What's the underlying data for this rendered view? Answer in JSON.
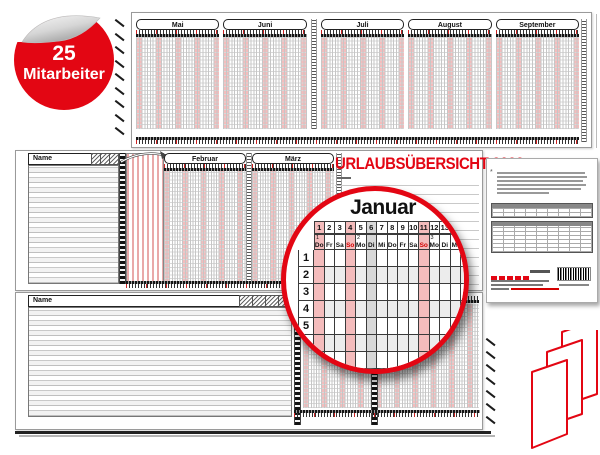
{
  "badge": {
    "count": "25",
    "label": "Mitarbeiter"
  },
  "title": "URLAUBSÜBERSICHT 2022",
  "top_sheet": {
    "months": [
      "Mai",
      "Juni",
      "Juli",
      "August",
      "September"
    ]
  },
  "middle_sheet": {
    "name_header": "Name",
    "months": [
      "Februar",
      "März"
    ]
  },
  "bottom_sheet": {
    "name_header": "Name"
  },
  "magnifier": {
    "month": "Januar",
    "day_numbers": [
      "1",
      "2",
      "3",
      "4",
      "5",
      "6",
      "7",
      "8",
      "9",
      "10",
      "11",
      "12",
      "13",
      "14",
      "15",
      "16",
      "17"
    ],
    "weekdays": [
      "Do",
      "Fr",
      "Sa",
      "So",
      "Mo",
      "Di",
      "Mi",
      "Do",
      "Fr",
      "Sa",
      "So",
      "Mo",
      "Di",
      "Mi",
      "Do",
      "Fr",
      "Sa"
    ],
    "week_numbers": {
      "0": "1",
      "4": "2",
      "11": "3"
    },
    "sunday_columns": [
      3,
      10
    ],
    "holiday_pink_columns": [
      0,
      3,
      10
    ],
    "holiday_gray_columns": [
      5
    ],
    "row_labels": [
      "1",
      "2",
      "3",
      "4",
      "5",
      "6"
    ],
    "footnote_marker": "*"
  },
  "colors": {
    "brand_red": "#e30613",
    "sunday_red": "#d40000",
    "weekend_pink": "#f4bcbc",
    "holiday_gray": "#d8d8d8",
    "row_alt_gray": "#ececec"
  },
  "icons": {
    "badge_curl": "page-curl-icon",
    "magnifier": "magnifier-circle",
    "fold_diagram": "zigzag-fold-icon",
    "fold_arrow": "fold-arrow-icon",
    "barcode": "barcode"
  }
}
